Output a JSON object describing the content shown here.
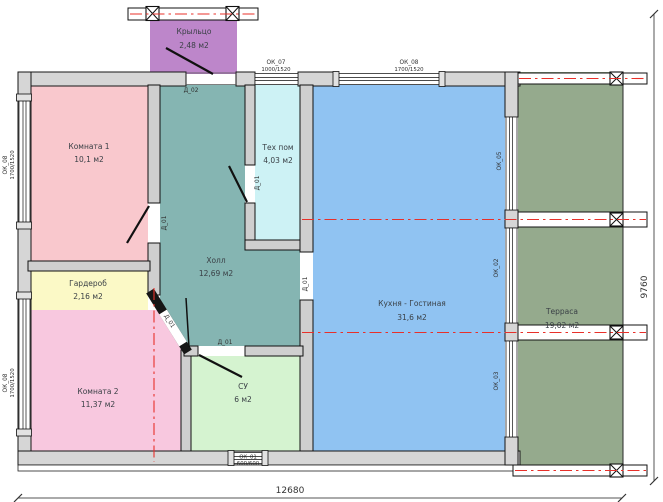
{
  "rooms": {
    "porch": {
      "name": "Крыльцо",
      "area": "2,48 м2"
    },
    "room1": {
      "name": "Комната 1",
      "area": "10,1 м2"
    },
    "tech": {
      "name": "Тех пом",
      "area": "4,03 м2"
    },
    "hall": {
      "name": "Холл",
      "area": "12,69 м2"
    },
    "wardrobe": {
      "name": "Гардероб",
      "area": "2,16 м2"
    },
    "room2": {
      "name": "Комната 2",
      "area": "11,37 м2"
    },
    "bathroom": {
      "name": "СУ",
      "area": "6 м2"
    },
    "kitchen": {
      "name": "Кухня - Гостиная",
      "area": "31,6 м2"
    },
    "terrace": {
      "name": "Терраса",
      "area": "19,02 м2"
    }
  },
  "windows": {
    "ok07": {
      "label": "ОК_07",
      "size": "1000/1520"
    },
    "ok08_top": {
      "label": "ОК_08",
      "size": "1700/1520"
    },
    "ok08_left_upper": {
      "label": "ОК_08",
      "size": "1700/1520"
    },
    "ok08_left_lower": {
      "label": "ОК_08",
      "size": "1700/1520"
    },
    "ok01_bottom": {
      "label": "ОК_01",
      "size": "600/600"
    },
    "ok05": {
      "label": "ОК_05"
    },
    "ok02": {
      "label": "ОК_02"
    },
    "ok03": {
      "label": "ОК_03"
    }
  },
  "doors": {
    "d02_entry": {
      "label": "Д_02"
    },
    "d01_room1": {
      "label": "Д_01"
    },
    "d01_tech": {
      "label": "Д_01"
    },
    "d01_kitchen": {
      "label": "Д_01"
    },
    "d01_bathroom": {
      "label": "Д_01"
    },
    "d01_room2": {
      "label": "Д_01"
    }
  },
  "dimensions": {
    "width_mm": "12680",
    "height_mm": "9760"
  },
  "colors": {
    "room1": "#f9c8cd",
    "room2": "#f8c8df",
    "wardrobe": "#fbf9c6",
    "hall": "#85b5b2",
    "tech": "#cdf2f5",
    "bathroom": "#d5f3d0",
    "kitchen": "#90c3f2",
    "terrace": "#95aa8d",
    "porch": "#bd86ca",
    "wall": "#d6d6d6",
    "axis_red": "#e8302a"
  }
}
